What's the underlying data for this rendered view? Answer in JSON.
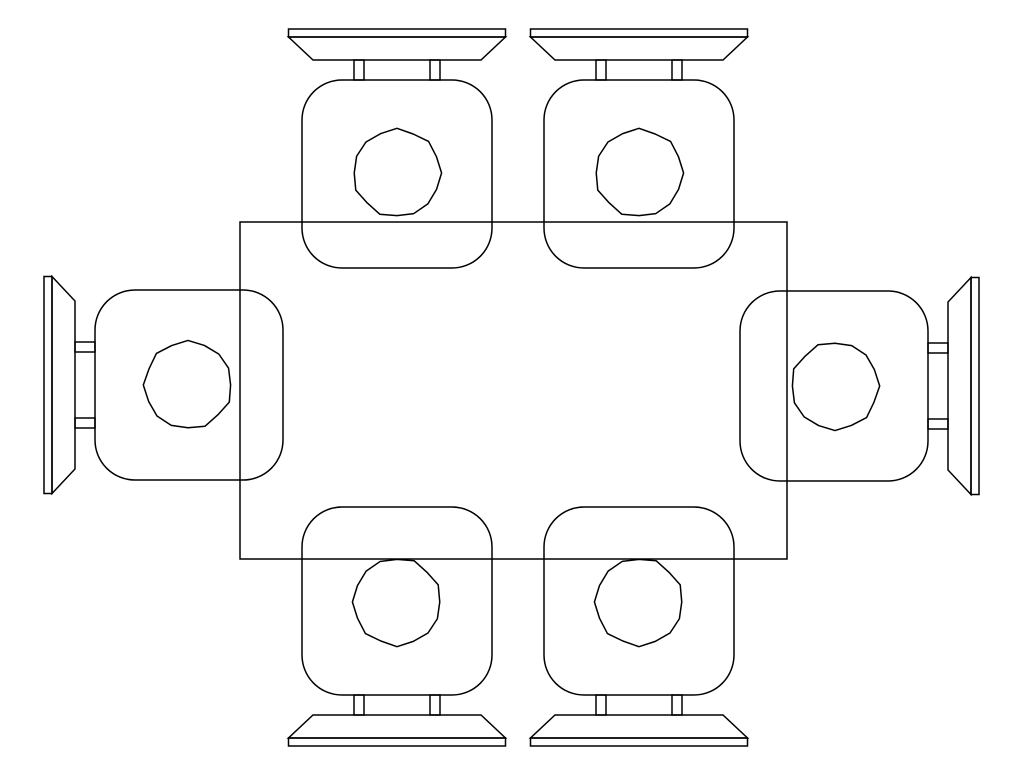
{
  "drawing": {
    "canvas": {
      "width": 1027,
      "height": 776,
      "background": "#ffffff"
    },
    "line": {
      "color": "#000000",
      "width": 1.5
    },
    "table": {
      "x": 240,
      "y": 222,
      "width": 547,
      "height": 337
    },
    "chair_template": {
      "backrest_bar": {
        "x": -108.5,
        "y": -144,
        "width": 217,
        "height": 8
      },
      "backrest_pad_points": [
        [
          -108.5,
          -136
        ],
        [
          108.5,
          -136
        ],
        [
          84,
          -113
        ],
        [
          -84,
          -113
        ]
      ],
      "rails": [
        {
          "x": -43,
          "y": -113,
          "width": 10,
          "height": 20
        },
        {
          "x": 33,
          "y": -113,
          "width": 10,
          "height": 20
        }
      ],
      "seat": {
        "x": -95,
        "y": -93,
        "width": 190,
        "height": 188,
        "corner_radius": 40
      },
      "cushion": {
        "cx": 0,
        "cy": 0,
        "r": 43.5,
        "segments": 16,
        "jitter": 1.3
      }
    },
    "chairs": [
      {
        "id": "chair-top-left",
        "cx": 397,
        "cy": 173,
        "rotation": 0
      },
      {
        "id": "chair-top-right",
        "cx": 639,
        "cy": 173,
        "rotation": 0
      },
      {
        "id": "chair-right",
        "cx": 835,
        "cy": 386,
        "rotation": 90
      },
      {
        "id": "chair-bottom-right",
        "cx": 639,
        "cy": 602,
        "rotation": 180
      },
      {
        "id": "chair-bottom-left",
        "cx": 397,
        "cy": 602,
        "rotation": 180
      },
      {
        "id": "chair-left",
        "cx": 188,
        "cy": 385,
        "rotation": 270
      }
    ]
  }
}
